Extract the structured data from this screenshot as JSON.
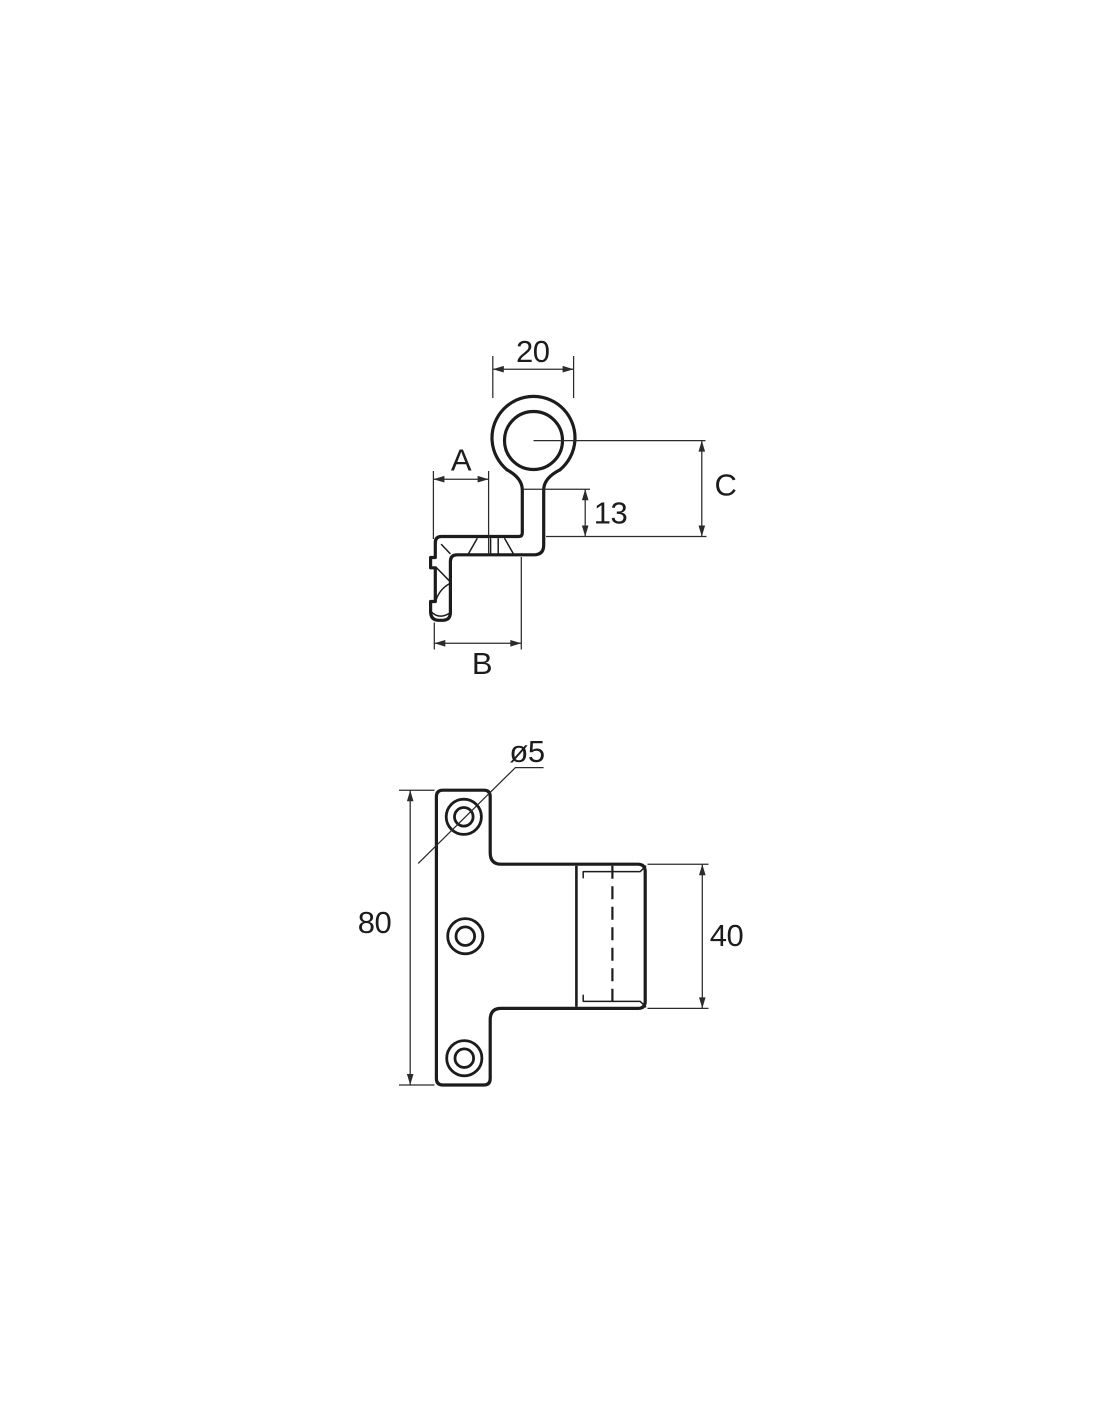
{
  "colors": {
    "ink": "#1c1c1c",
    "dimension_lines": "#2b2b2b",
    "background": "#ffffff"
  },
  "side_view": {
    "dim_ring_width": "20",
    "dim_a": "A",
    "dim_neck_drop": "13",
    "dim_c": "C",
    "dim_b": "B"
  },
  "front_view": {
    "dim_hole_diameter": "ø5",
    "dim_plate_height": "80",
    "dim_boss_diameter": "40"
  }
}
